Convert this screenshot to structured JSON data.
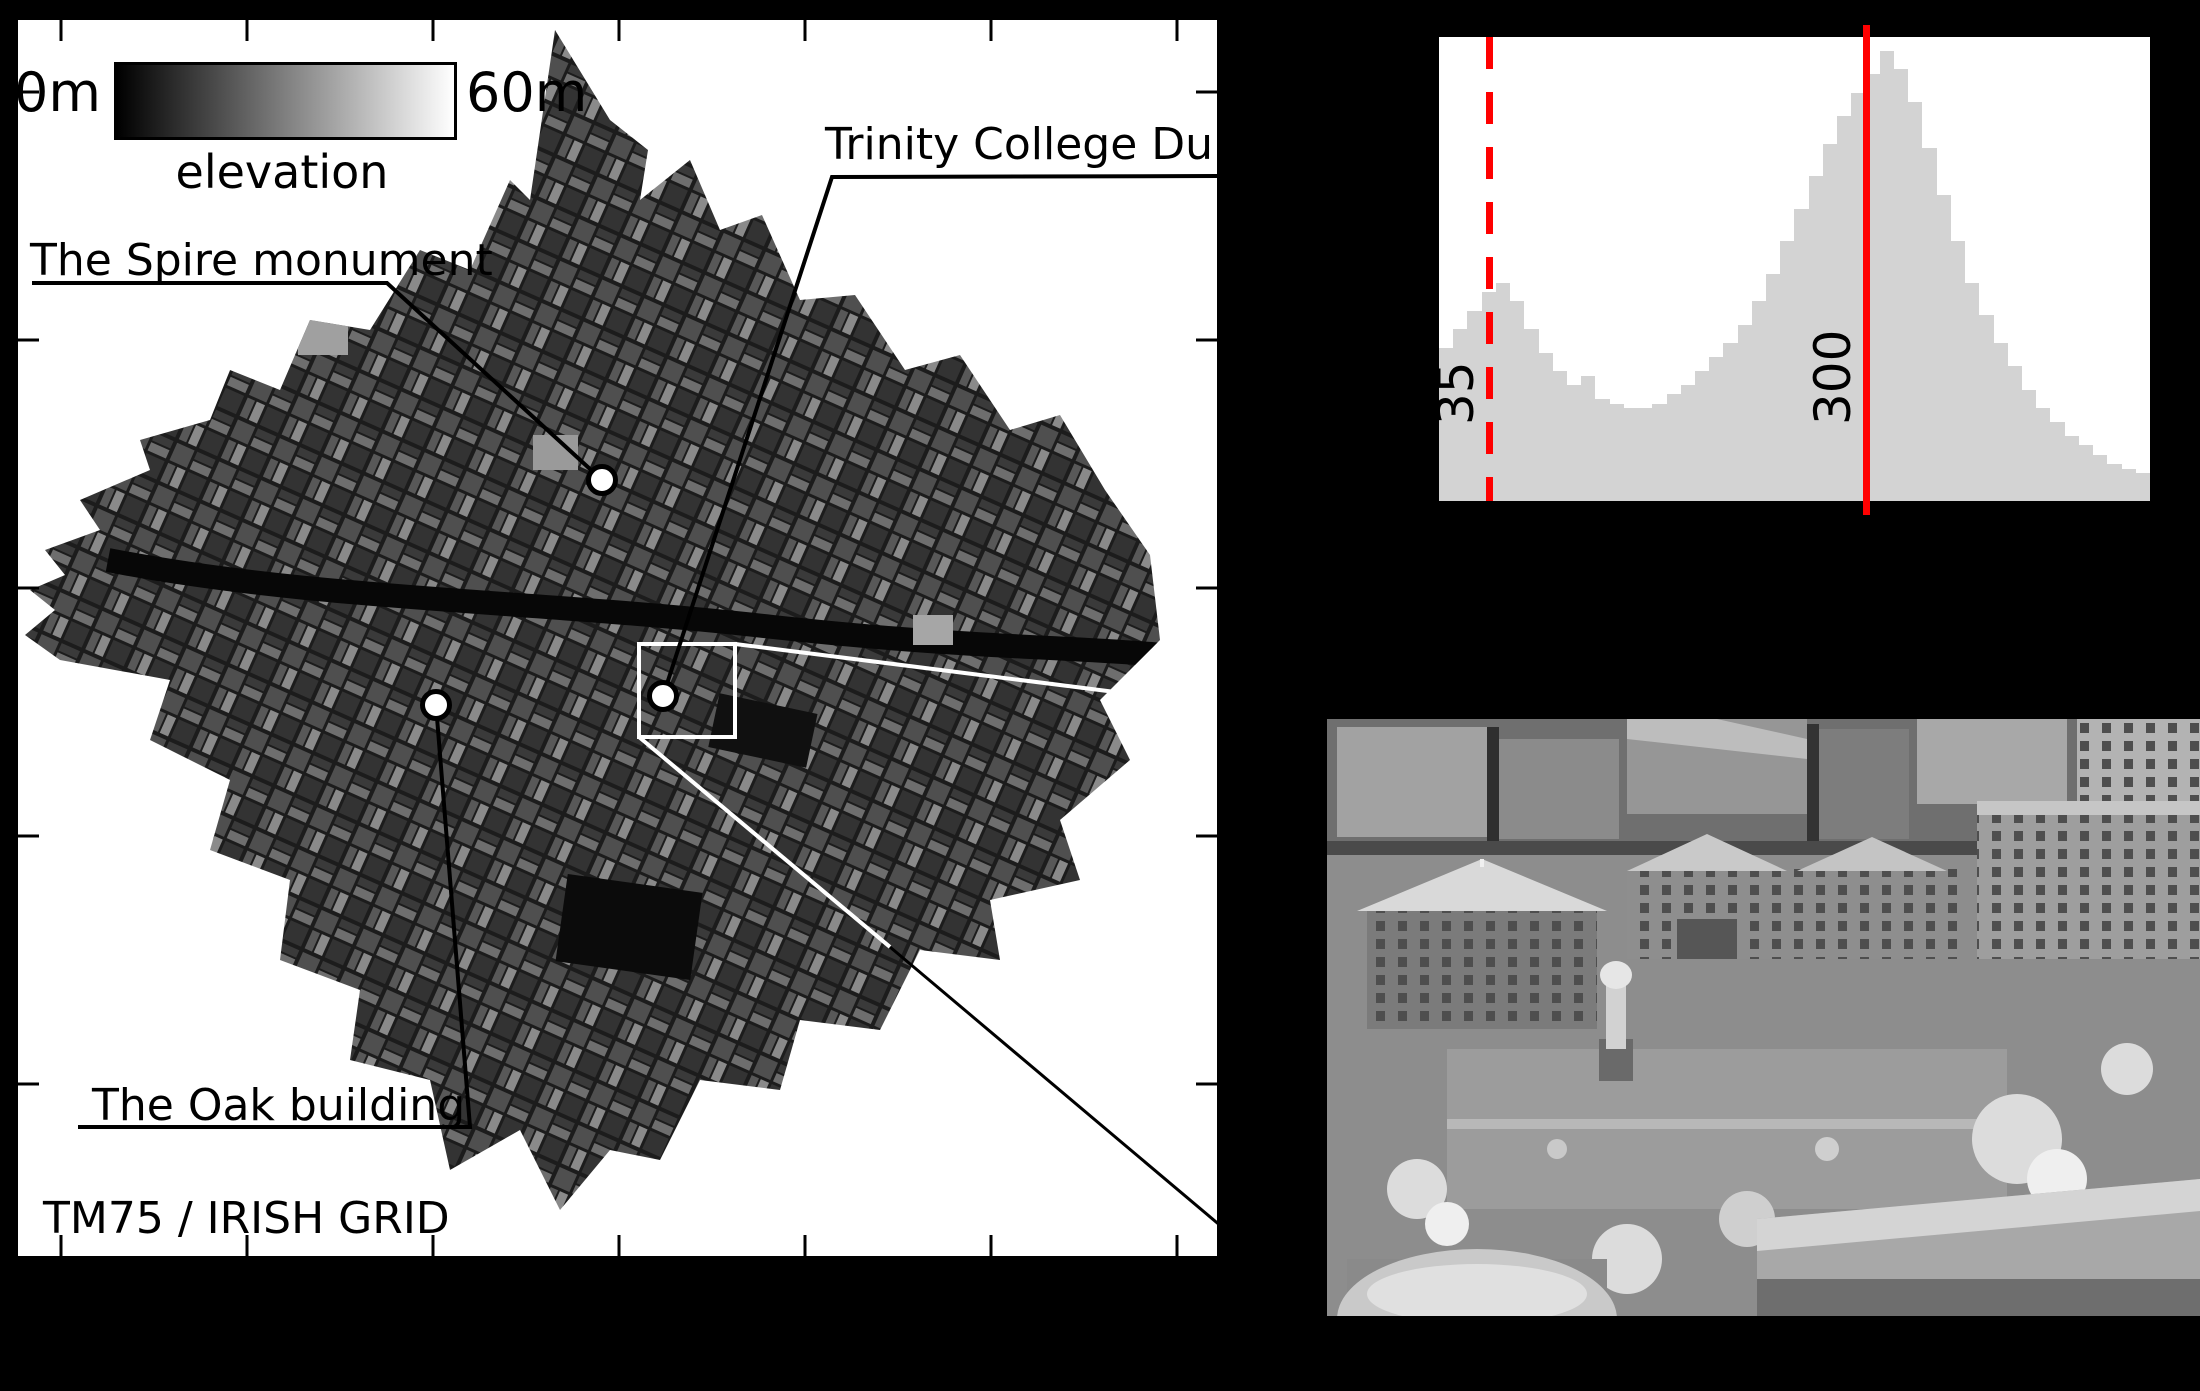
{
  "figure": {
    "background": "#000000"
  },
  "map": {
    "labels": {
      "spire": "The Spire monument",
      "trinity": "Trinity College Dublin",
      "oak": "The Oak building",
      "grid": "TM75 / IRISH GRID"
    },
    "colorbar": {
      "min": "0m",
      "max": "60m",
      "title": "elevation",
      "start_color": "#000000",
      "end_color": "#ffffff"
    }
  },
  "chart_data": {
    "type": "bar",
    "title": "",
    "xlabel": "",
    "ylabel": "",
    "xlim": [
      0,
      500
    ],
    "grid": false,
    "background": "#ffffff",
    "bar_color": "#d3d3d3",
    "values_norm": [
      0.33,
      0.37,
      0.41,
      0.45,
      0.47,
      0.43,
      0.37,
      0.32,
      0.28,
      0.25,
      0.27,
      0.22,
      0.21,
      0.2,
      0.2,
      0.21,
      0.23,
      0.25,
      0.28,
      0.31,
      0.34,
      0.38,
      0.43,
      0.49,
      0.56,
      0.63,
      0.7,
      0.77,
      0.83,
      0.88,
      0.92,
      0.97,
      0.93,
      0.86,
      0.76,
      0.66,
      0.56,
      0.47,
      0.4,
      0.34,
      0.29,
      0.24,
      0.2,
      0.17,
      0.14,
      0.12,
      0.1,
      0.08,
      0.07,
      0.06
    ],
    "markers": [
      {
        "value": 35,
        "label": "35",
        "style": "dashed",
        "color": "#ff0000"
      },
      {
        "value": 300,
        "label": "300",
        "style": "solid",
        "color": "#ff0000"
      }
    ]
  }
}
